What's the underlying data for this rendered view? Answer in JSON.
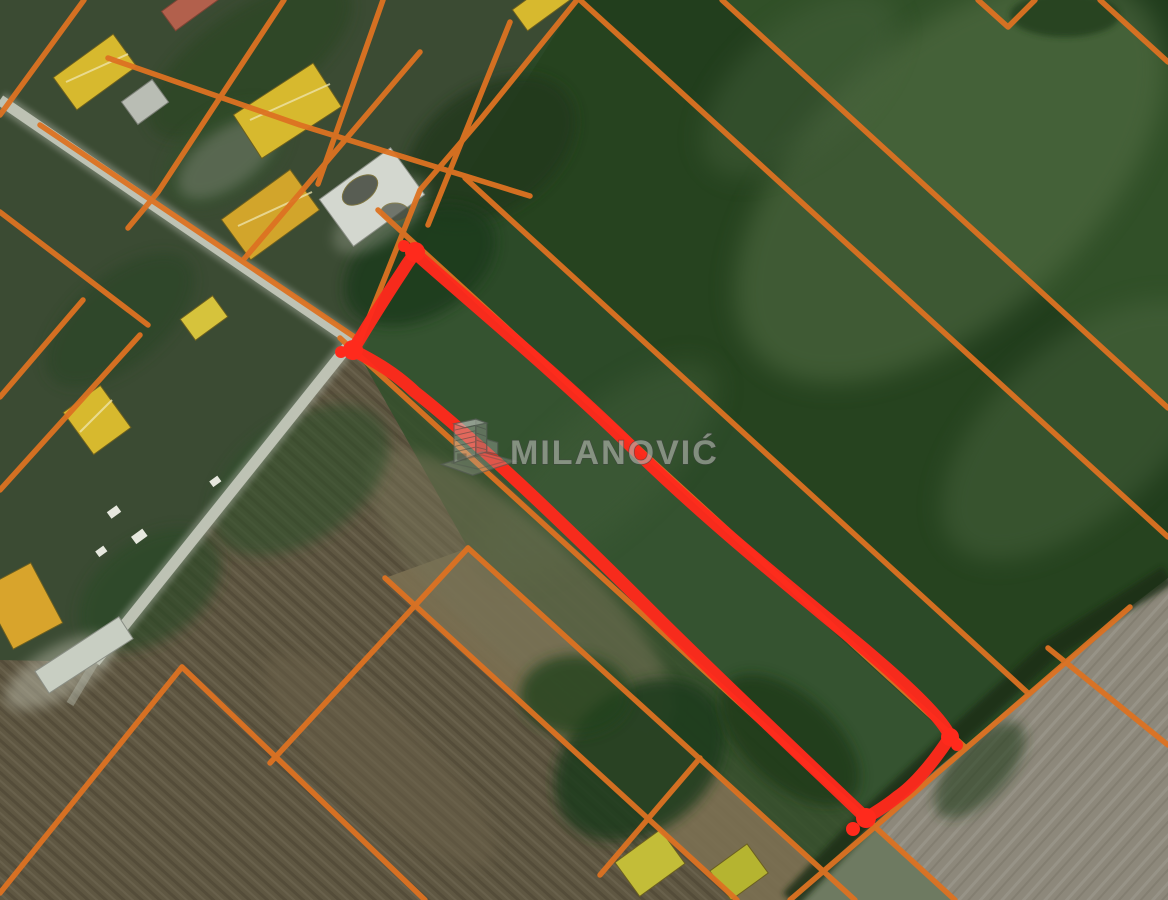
{
  "watermark": {
    "text": "MILANOVIĆ",
    "icon": "building-icon"
  },
  "map": {
    "description": "aerial satellite view with cadastral parcel overlay and one highlighted parcel",
    "colors": {
      "boundary_orange": "#dd7222",
      "highlight_red": "#ff2a1c",
      "road_gray": "#c2c6b8",
      "field_green_dark": "#223e1d",
      "field_green_light": "#587248",
      "field_brown": "#5f5742",
      "field_gray": "#8d887b",
      "roof_yellow": "#d7b92e"
    },
    "highlighted_parcel": {
      "shape": "long-narrow-strip",
      "corner_count": 4
    }
  }
}
